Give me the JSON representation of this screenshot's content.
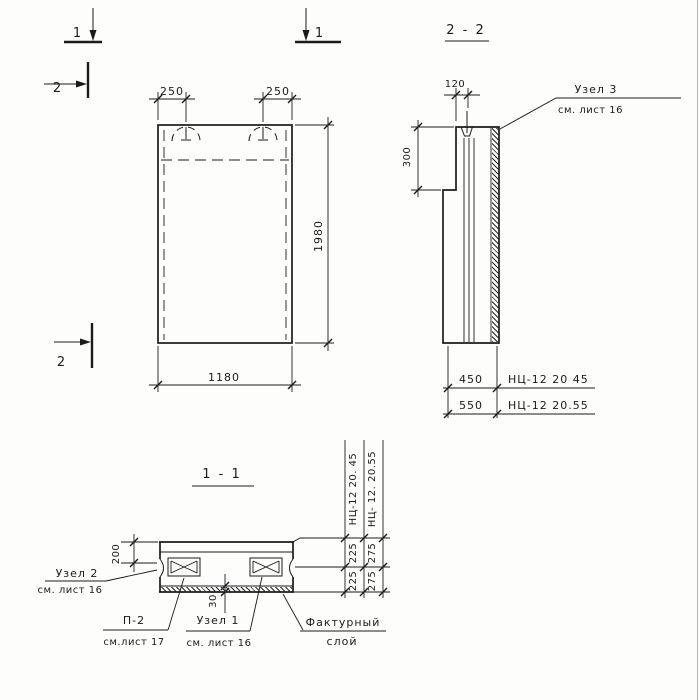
{
  "markers": {
    "one_left": "1",
    "one_right": "1",
    "two_top": "2",
    "two_bottom": "2"
  },
  "front_view": {
    "dim_250_left": "250",
    "dim_250_right": "250",
    "dim_width": "1180",
    "dim_height": "1980"
  },
  "section_2_2": {
    "title": "2 - 2",
    "dim_top": "120",
    "dim_step": "300",
    "rows": [
      {
        "dim": "450",
        "mark": "НЦ-12 20 45"
      },
      {
        "dim": "550",
        "mark": "НЦ-12 20.55"
      }
    ],
    "node3": {
      "title": "Узел 3",
      "ref": "см. лист 16"
    }
  },
  "section_1_1": {
    "title": "1 - 1",
    "dim_top": "200",
    "dim_layer": "30",
    "columns": [
      {
        "mark": "НЦ-12 20. 45",
        "upper": "225",
        "lower": "225"
      },
      {
        "mark": "НЦ- 12. 20.55",
        "upper": "275",
        "lower": "275"
      }
    ],
    "node2": {
      "title": "Узел 2",
      "ref": "см. лист 16"
    },
    "p2": {
      "title": "П-2",
      "ref": "см.лист 17"
    },
    "node1": {
      "title": "Узел 1",
      "ref": "см. лист 16"
    },
    "facing": {
      "line1": "Фактурный",
      "line2": "слой"
    }
  }
}
